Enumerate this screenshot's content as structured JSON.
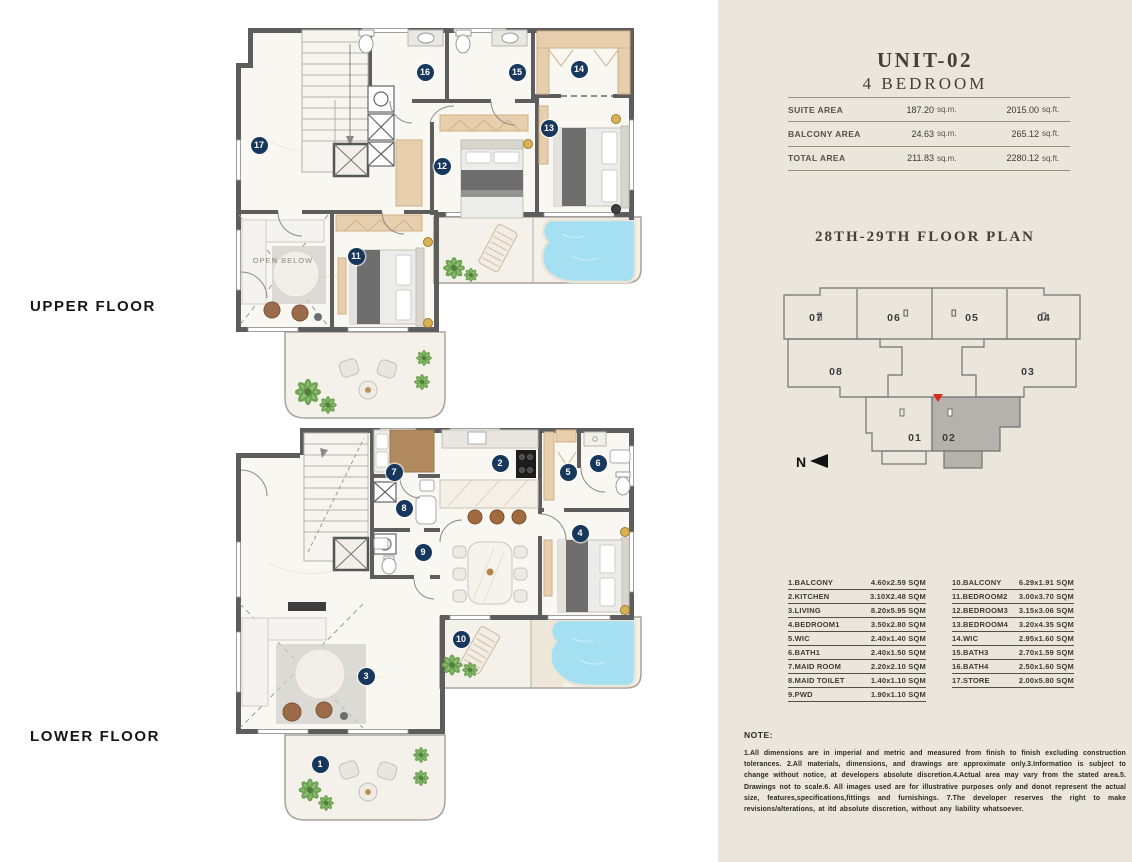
{
  "colors": {
    "panel_bg": "#eae6db",
    "badge": "#17375c",
    "wall": "#5d5d5d",
    "wood": "#e7cfad",
    "pool": "#a5dff2",
    "plant": "#7cb065",
    "highlighted_unit_fill": "#b5b2ac",
    "marker_red": "#e02818"
  },
  "plans": {
    "upper": {
      "label": "UPPER FLOOR",
      "open_below_label": "OPEN BELOW",
      "badges": [
        {
          "n": "17",
          "x": 31,
          "y": 125
        },
        {
          "n": "16",
          "x": 197,
          "y": 52
        },
        {
          "n": "15",
          "x": 289,
          "y": 52
        },
        {
          "n": "14",
          "x": 351,
          "y": 49
        },
        {
          "n": "13",
          "x": 321,
          "y": 108
        },
        {
          "n": "12",
          "x": 214,
          "y": 146
        },
        {
          "n": "11",
          "x": 128,
          "y": 236
        }
      ]
    },
    "lower": {
      "label": "LOWER FLOOR",
      "badges": [
        {
          "n": "7",
          "x": 166,
          "y": 50
        },
        {
          "n": "2",
          "x": 272,
          "y": 41
        },
        {
          "n": "5",
          "x": 340,
          "y": 50
        },
        {
          "n": "6",
          "x": 370,
          "y": 41
        },
        {
          "n": "8",
          "x": 176,
          "y": 86
        },
        {
          "n": "9",
          "x": 195,
          "y": 130
        },
        {
          "n": "4",
          "x": 352,
          "y": 111
        },
        {
          "n": "10",
          "x": 233,
          "y": 217
        },
        {
          "n": "3",
          "x": 138,
          "y": 254
        },
        {
          "n": "1",
          "x": 92,
          "y": 342
        }
      ]
    }
  },
  "panel": {
    "unit_title": "UNIT-02",
    "unit_subtitle": "4 BEDROOM",
    "area_table": [
      {
        "label": "SUITE AREA",
        "sqm": "187.20",
        "sqm_unit": "sq.m.",
        "sqft": "2015.00",
        "sqft_unit": "sq.ft."
      },
      {
        "label": "BALCONY AREA",
        "sqm": "24.63",
        "sqm_unit": "sq.m.",
        "sqft": "265.12",
        "sqft_unit": "sq.ft."
      },
      {
        "label": "TOTAL AREA",
        "sqm": "211.83",
        "sqm_unit": "sq.m.",
        "sqft": "2280.12",
        "sqft_unit": "sq.ft."
      }
    ],
    "floor_plan_title": "28TH-29TH FLOOR PLAN",
    "key_plan": {
      "north_label": "N",
      "highlighted_unit": "02",
      "units": [
        {
          "id": "07"
        },
        {
          "id": "06"
        },
        {
          "id": "05"
        },
        {
          "id": "04"
        },
        {
          "id": "08"
        },
        {
          "id": "03"
        },
        {
          "id": "01"
        },
        {
          "id": "02"
        }
      ]
    },
    "legend_left": [
      {
        "name": "1.BALCONY",
        "size": "4.60x2.59 SQM"
      },
      {
        "name": "2.KITCHEN",
        "size": "3.10X2.48 SQM"
      },
      {
        "name": "3.LIVING",
        "size": "8.20x5.95 SQM"
      },
      {
        "name": "4.BEDROOM1",
        "size": "3.50x2.80 SQM"
      },
      {
        "name": "5.WIC",
        "size": "2.40x1.40 SQM"
      },
      {
        "name": "6.BATH1",
        "size": "2.40x1.50 SQM"
      },
      {
        "name": "7.MAID ROOM",
        "size": "2.20x2.10 SQM"
      },
      {
        "name": "8.MAID TOILET",
        "size": "1.40x1.10 SQM"
      },
      {
        "name": "9.PWD",
        "size": "1.90x1.10 SQM"
      }
    ],
    "legend_right": [
      {
        "name": "10.BALCONY",
        "size": "6.29x1.91 SQM"
      },
      {
        "name": "11.BEDROOM2",
        "size": "3.00x3.70 SQM"
      },
      {
        "name": "12.BEDROOM3",
        "size": "3.15x3.06 SQM"
      },
      {
        "name": "13.BEDROOM4",
        "size": "3.20x4.35 SQM"
      },
      {
        "name": "14.WIC",
        "size": "2.95x1.60 SQM"
      },
      {
        "name": "15.BATH3",
        "size": "2.70x1.59 SQM"
      },
      {
        "name": "16.BATH4",
        "size": "2.50x1.60 SQM"
      },
      {
        "name": "17.STORE",
        "size": "2.00x5.80 SQM"
      }
    ],
    "note_title": "NOTE:",
    "note_body": "1.All dimensions are in imperial and metric and measured from finish to finish excluding construction tolerances. 2.All materials, dimensions, and drawings are approximate only.3.Information is subject to change without notice, at developers absolute discretion.4.Actual area may vary from the stated area.5. Drawings not to scale.6. All images used are for illustrative purposes only and donot represent the actual size, features,specifications,fittings and furnishings. 7.The developer reserves the right to make revisions/alterations, at itd absolute discretion, without any liability whatsoever."
  }
}
